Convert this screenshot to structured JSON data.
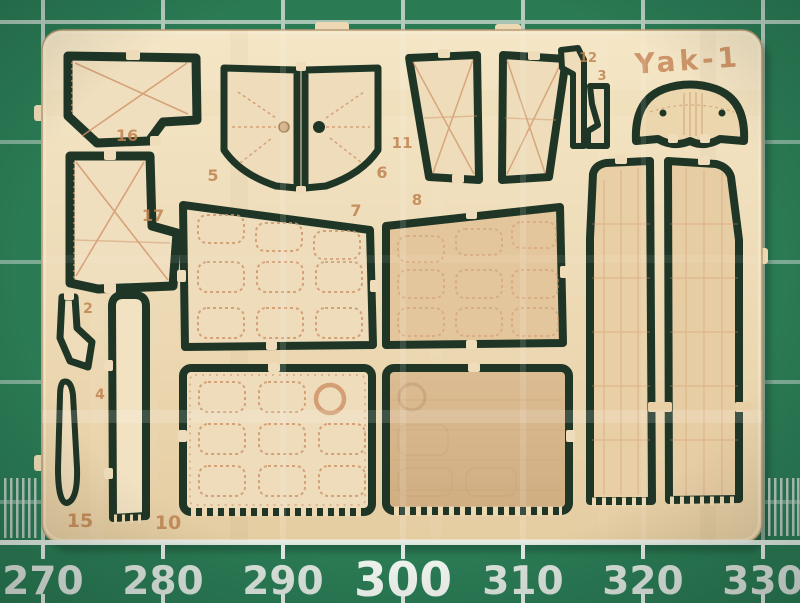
{
  "scene": {
    "subject": "Photo-etched brass detail fret for a Yak-1 model aircraft kit",
    "surface": "Green self-healing cutting mat with 10 mm grid and millimetre ruler scale",
    "brand_etch": "Yak-1"
  },
  "colors": {
    "mat_green": "#2a7a54",
    "mat_grid": "#d7e0d9",
    "ruler_text": "#d9e2db",
    "brass_light": "#f0dfbe",
    "brass_mid": "#e8d2ab",
    "brass_dark_panel": "#d6b58a",
    "etch_red": "#cf9468",
    "cutout_dark": "#1f3627"
  },
  "ruler": {
    "labels": [
      "270",
      "280",
      "290",
      "300",
      "310",
      "320",
      "330"
    ],
    "emphasized_label": "300"
  },
  "fret": {
    "brand": "Yak-1",
    "part_labels": {
      "p2": "2",
      "p3": "3",
      "p4": "4",
      "p5": "5",
      "p6": "6",
      "p7": "7",
      "p8": "8",
      "p10": "10",
      "p11": "11",
      "p12": "12",
      "p15": "15",
      "p16": "16",
      "p17": "17"
    }
  }
}
